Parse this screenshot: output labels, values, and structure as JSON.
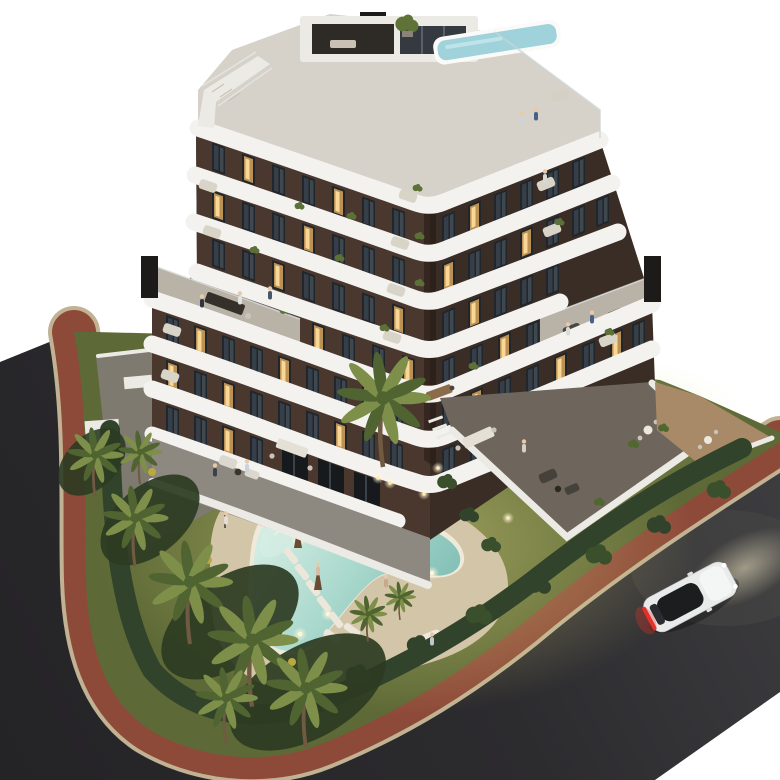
{
  "scene": {
    "description": "Aerial dusk 3D architectural rendering of a modern seven-storey apartment building with curved white wrap-around balconies, rooftop plunge pool and stair, landscaped garden with free-form lit swimming pool, sun loungers, closed umbrellas and palm trees, brick-red sidewalks wrapping a corner between dark asphalt streets, and a white car driving on the lower road",
    "building": {
      "label": "apartment-building",
      "floors_visible": 7,
      "balcony_style": "curved white bands",
      "facade_material": "dark chocolate brown panels",
      "rooftop": {
        "plunge_pool": true,
        "penthouse_box": true,
        "external_stair": true,
        "chimneys": 3,
        "roof_terraces": 3
      }
    },
    "pool": {
      "label": "free-form-pool",
      "shape": "boomerang",
      "underwater_lights": 6,
      "loungers": 7,
      "umbrellas_closed": 2,
      "daybed": true
    },
    "garden": {
      "palm_trees": 10,
      "hedgerows": true,
      "lawn": true,
      "gravel_island": true,
      "uplights": 5
    },
    "streets": {
      "left_road": true,
      "lower_road": true,
      "sidewalk_material": "red brick with light curb"
    },
    "vehicle": {
      "label": "white-car",
      "state": "driving",
      "taillights_on": true,
      "headlights_on": true
    },
    "people_visible": 15
  },
  "colors": {
    "bg": "#ffffff",
    "asphalt": "#29282b",
    "asphalt-light": "#413f43",
    "sidewalk": "#8e4a39",
    "curb": "#c2b294",
    "garden": "#5d6936",
    "lawn-glow": "#d8d27f",
    "hedge": "#31432a",
    "frond": "#7d8f49",
    "frond-dark": "#4f6430",
    "trunk": "#705a42",
    "sand-deck": "#d3c5a7",
    "pool-shallow": "#d8efe6",
    "pool-deep": "#6fb3ab",
    "pool-rim": "#efe9da",
    "facade": "#4a382e",
    "facade-dark": "#3a2d25",
    "band": "#f3f2ef",
    "roof-deck": "#d6d2c9",
    "terrace-floor": "#b9b2a6",
    "patio": "#7e7a70",
    "stone": "#6e655c",
    "wall-white": "#eceae5",
    "window-dark": "#20262b",
    "window-lit": "#c99a58",
    "frame": "#d8d5cf",
    "chimney": "#1d1b19",
    "terra": "#a98a68",
    "car-body": "#e9eaea",
    "car-glass": "#1b1d1f",
    "tail-red": "#e23228",
    "glow": "#ffd9a0",
    "skin": "#e8c9a8",
    "gravel": "#9a958c"
  }
}
